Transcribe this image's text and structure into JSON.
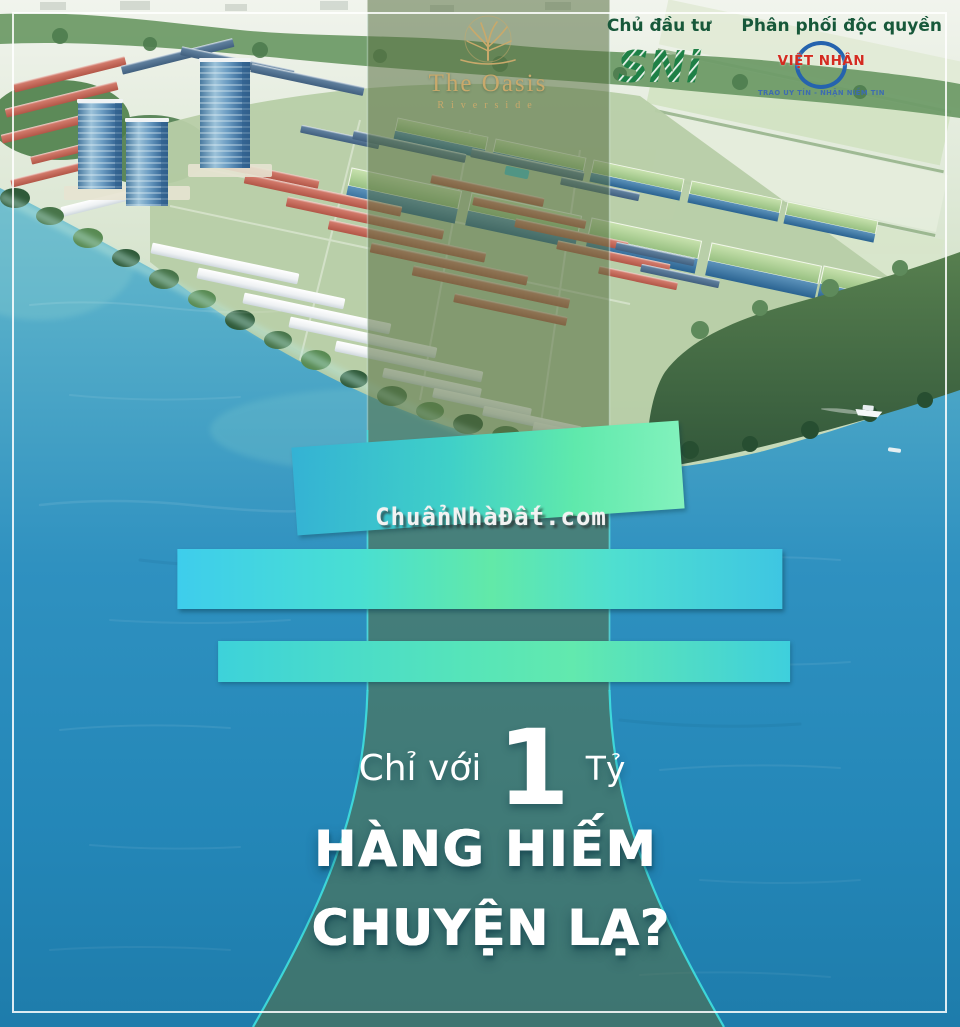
{
  "branding": {
    "project": {
      "name": "The Oasis",
      "subtitle": "Riverside",
      "icon": "gold-tree-icon"
    },
    "developer": {
      "label": "Chủ đầu tư",
      "logo_text": "SNi"
    },
    "distributor": {
      "label": "Phân phối độc quyền",
      "logo_text": "VIỆT NHÂN",
      "tagline": "TRAO UY TÍN - NHẬN NIỀM TIN"
    }
  },
  "headline": {
    "script": "Sở Hữu",
    "main": "BIỆT THỰ VEN SÔNG",
    "sub": "Đẳng Cấp Bậc Nhất Bình Dương"
  },
  "offer": {
    "prefix": "Chỉ với",
    "number": "1",
    "unit": "Tỷ"
  },
  "taglines": [
    "HÀNG HIẾM",
    "CHUYỆN LẠ?"
  ],
  "watermark": "ChuẩnNhàĐất.com",
  "colors": {
    "water_blue": "#2d8fc0",
    "band_overlay": "rgba(88,112,66,0.55)",
    "band_edge_cyan": "#3fe0e0",
    "gradient_cyan": "#3ecdec",
    "gradient_mint": "#62e9a8",
    "gold": "#c9a96b",
    "label_green": "#17583a",
    "sni_green": "#1e8046",
    "vn_red": "#d42b20",
    "vn_blue": "#2563ae",
    "white": "#ffffff"
  }
}
